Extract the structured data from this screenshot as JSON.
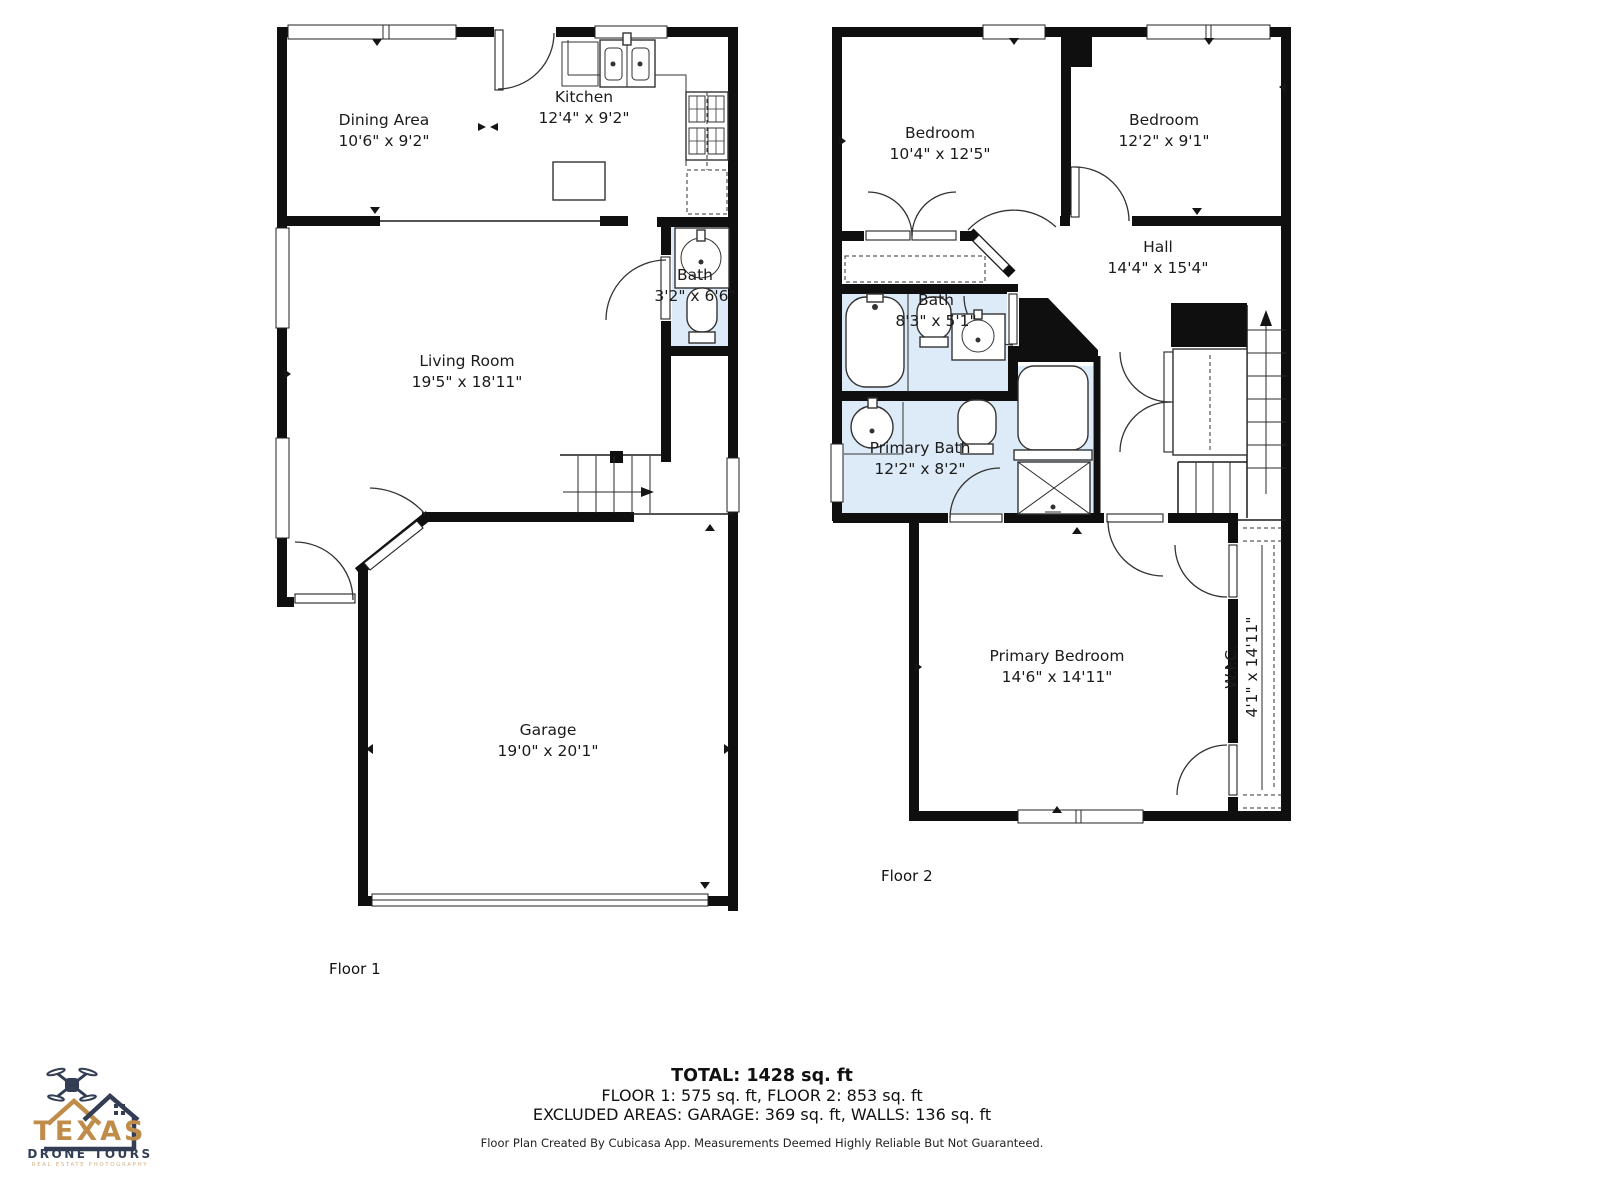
{
  "colors": {
    "wall": "#0f0f0f",
    "bath_fill": "#dcebf7",
    "logo_gold": "#bf8c4a",
    "logo_navy": "#333d54"
  },
  "floor1": {
    "label": "Floor 1",
    "rooms": [
      {
        "name": "Dining Area",
        "dims": "10'6\" x 9'2\""
      },
      {
        "name": "Kitchen",
        "dims": "12'4\" x 9'2\""
      },
      {
        "name": "Living Room",
        "dims": "19'5\" x 18'11\""
      },
      {
        "name": "Bath",
        "dims": "3'2\" x 6'6\""
      },
      {
        "name": "Garage",
        "dims": "19'0\" x 20'1\""
      }
    ]
  },
  "floor2": {
    "label": "Floor 2",
    "rooms": [
      {
        "name": "Bedroom",
        "dims": "10'4\" x 12'5\""
      },
      {
        "name": "Bedroom",
        "dims": "12'2\" x 9'1\""
      },
      {
        "name": "Hall",
        "dims": "14'4\" x 15'4\""
      },
      {
        "name": "Bath",
        "dims": "8'3\" x 5'1\""
      },
      {
        "name": "Primary Bath",
        "dims": "12'2\" x 8'2\""
      },
      {
        "name": "Primary Bedroom",
        "dims": "14'6\" x 14'11\""
      },
      {
        "name": "W.I.C.",
        "dims": "4'1\" x 14'11\""
      }
    ]
  },
  "summary": {
    "total": "TOTAL: 1428 sq. ft",
    "floors": "FLOOR 1: 575 sq. ft, FLOOR 2: 853 sq. ft",
    "excluded": "EXCLUDED AREAS: GARAGE: 369 sq. ft, WALLS: 136 sq. ft"
  },
  "footer": {
    "disclaimer": "Floor Plan Created By Cubicasa App. Measurements Deemed Highly Reliable But Not Guaranteed."
  },
  "logo": {
    "title": "TEXAS",
    "subtitle": "DRONE TOURS",
    "tagline": "REAL ESTATE PHOTOGRAPHY"
  }
}
